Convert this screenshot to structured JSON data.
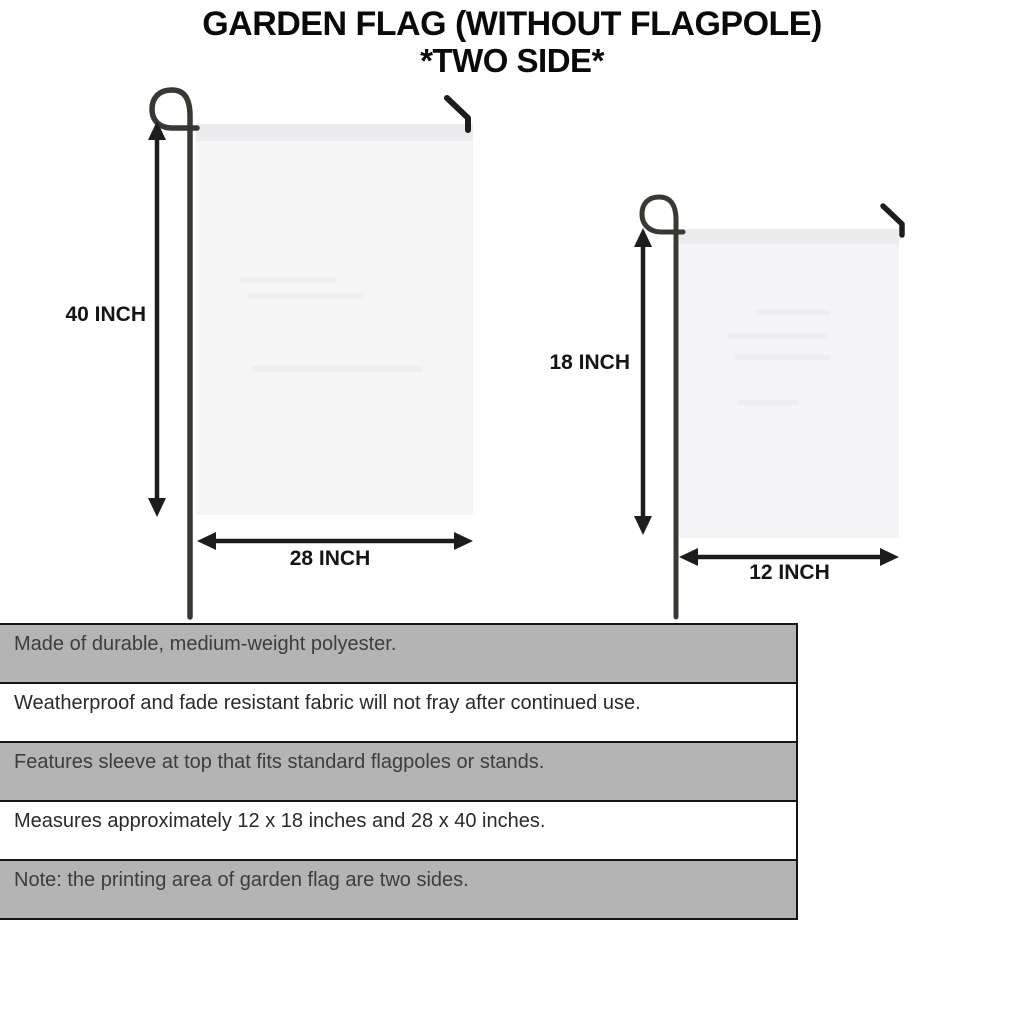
{
  "title": {
    "line1": "GARDEN FLAG (WITHOUT FLAGPOLE)",
    "line2": "*TWO SIDE*"
  },
  "diagram": {
    "large_flag": {
      "height_label": "40 INCH",
      "width_label": "28 INCH"
    },
    "small_flag": {
      "height_label": "18 INCH",
      "width_label": "12 INCH"
    }
  },
  "features": [
    "Made of durable, medium-weight polyester.",
    "Weatherproof and fade resistant fabric will not fray after continued use.",
    "Features sleeve at top that fits standard flagpoles or stands.",
    "Measures approximately 12 x 18 inches and 28 x 40 inches.",
    "Note: the printing area of garden flag are two sides."
  ],
  "colors": {
    "table_row_gray": "#b4b4b4",
    "table_border": "#161616",
    "flag_fill": "#f5f5f6",
    "flag_sleeve": "#ececee",
    "pole": "#3a3833",
    "arrow": "#1d1d1d",
    "text": "#0a0a0a"
  }
}
